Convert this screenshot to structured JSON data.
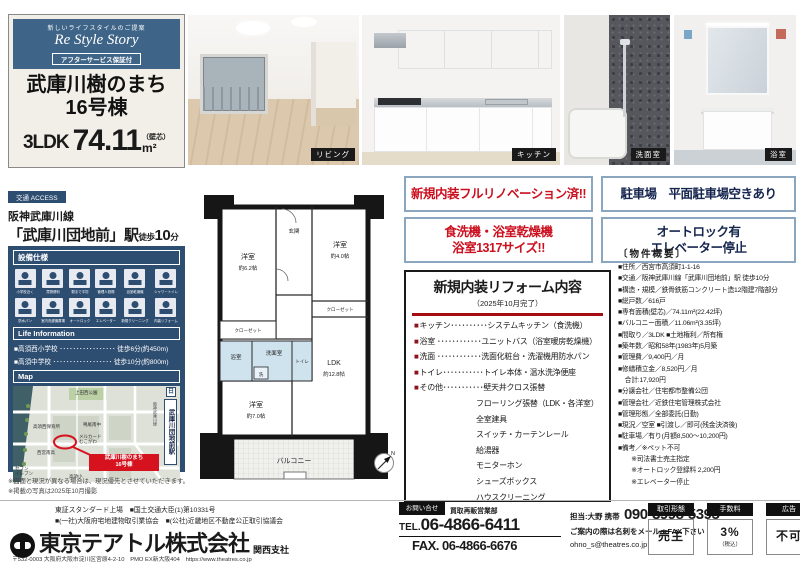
{
  "header": {
    "tagline": "新しいライフスタイルのご提案",
    "brand": "Re Style Story",
    "after_badge": "アフターサービス保証付",
    "name_line1": "武庫川樹のまち",
    "name_line2": "16号棟",
    "layout": "3LDK",
    "area": "74.11",
    "area_unit": "m²",
    "area_note": "（壁芯）"
  },
  "access": {
    "tag": "交通 ACCESS",
    "line": "阪神武庫川線",
    "station": "「武庫川団地前」駅",
    "walk_prefix": "徒歩",
    "walk_num": "10",
    "walk_suffix": "分"
  },
  "equipment": {
    "title": "設備仕様",
    "items": [
      {
        "icon": "school-icon",
        "label": "小学校近く"
      },
      {
        "icon": "shopping-icon",
        "label": "買物便利"
      },
      {
        "icon": "walk-icon",
        "label": "駅まで平坦"
      },
      {
        "icon": "manager-icon",
        "label": "管理人勤務"
      },
      {
        "icon": "shower-icon",
        "label": "浴室乾燥機"
      },
      {
        "icon": "toilet-icon",
        "label": "シャワートイレ"
      },
      {
        "icon": "laundry-pan-icon",
        "label": "防水パン"
      },
      {
        "icon": "washer-icon",
        "label": "室内洗濯機置場"
      },
      {
        "icon": "autolock-icon",
        "label": "オートロック"
      },
      {
        "icon": "elevator-icon",
        "label": "エレベーター"
      },
      {
        "icon": "cleaning-icon",
        "label": "新規クリーニング"
      },
      {
        "icon": "renovation-icon",
        "label": "内装リフォーム"
      }
    ]
  },
  "life": {
    "title": "Life Information",
    "items": [
      "■高須西小学校 ･････････････････ 徒歩6分(約450m)",
      "■高須中学校 ･･････････････････ 徒歩10分(約800m)"
    ]
  },
  "map": {
    "title": "Map",
    "labels": {
      "park": "上田西公園",
      "school_mid": "鳴尾南中",
      "nursery": "高須西保育所",
      "mall": "メルカード\nむこがわ",
      "high": "西宮南高",
      "conv": "セブン\nイレブン",
      "elem": "高須小"
    },
    "station": "武庫川団地前駅",
    "line": "阪神武庫川線",
    "logo": "日",
    "callout": "武庫川樹のまち\n16号棟"
  },
  "notes": [
    "※図面と現況が異なる場合は、現況優先とさせていただきます。",
    "※掲載の写真は2025年10月撮影"
  ],
  "photos": [
    {
      "caption": "リビング"
    },
    {
      "caption": "キッチン"
    },
    {
      "caption": "洗面室"
    },
    {
      "caption": "浴室"
    }
  ],
  "floorplan": {
    "balcony": "バルコニー",
    "genkan": "玄関",
    "w62": [
      "洋室",
      "約6.2帖"
    ],
    "w40": [
      "洋室",
      "約4.0帖"
    ],
    "w70": [
      "洋室",
      "約7.0帖"
    ],
    "ldk": [
      "LDK",
      "約12.8帖"
    ],
    "closet_left": "クローゼット",
    "closet_right": "クローゼット",
    "bath": "浴室",
    "wash": "洗面室",
    "toilet": "トイレ",
    "laundry": "洗",
    "compass": "N"
  },
  "highlights": [
    {
      "text": "新規内装フルリノベーション済!!",
      "tone": "red"
    },
    {
      "text": "駐車場　平面駐車場空きあり",
      "tone": "navy"
    },
    {
      "text": "食洗機・浴室乾燥機\n浴室1317サイズ!!",
      "tone": "red"
    },
    {
      "text": "オートロック有\nエレベーター停止",
      "tone": "navy"
    }
  ],
  "reform": {
    "title": "新規内装リフォーム内容",
    "subtitle": "（2025年10月完了）",
    "bullet": "■",
    "items": [
      "キッチン･･････････システムキッチン（食洗機）",
      "浴室 ････････････ユニットバス（浴室暖房乾燥機）",
      "洗面 ････････････洗面化粧台・洗濯機用防水パン",
      "トイレ･･･････････トイレ本体・温水洗浄便座",
      "その他･･･････････壁天井クロス張替"
    ],
    "extras": [
      "フローリング張替（LDK・各洋室）",
      "全室建具",
      "スイッチ・カーテンレール",
      "給湯器",
      "モニターホン",
      "シューズボックス",
      "ハウスクリーニング"
    ]
  },
  "outline": {
    "title": "〔物件概要〕",
    "items": [
      "■住所／西宮市高須町1-1-16",
      "■交通／阪神武庫川線「武庫川団地前」駅 徒歩10分",
      "■構造・規模／鉄骨鉄筋コンクリート造12階建7階部分",
      "■総戸数／616戸",
      "■専有面積(壁芯)／74.11m²(22.42坪)",
      "■バルコニー面積／11.06m²(3.35坪)",
      "■間取り／3LDK ■土地権利／所有権",
      "■築年数／昭和58年(1983年)5月築",
      "■管理費／9,400円／月",
      "■修繕積立金／8,520円／月",
      "　合計:17,920円",
      "■分譲会社／住宅都市整備公団",
      "■管理会社／近鉄住宅管理株式会社",
      "■管理形態／全部委託(日勤)",
      "■現況／空室 ■引渡し／即可(残金決済後)",
      "■駐車場／有り(月額8,500～10,200円)",
      "■備考／※ペット不可",
      "　　※司法書士売主指定",
      "　　※オートロック登録料 2,200円",
      "　　※エレベーター停止"
    ]
  },
  "footer": {
    "certs": [
      "東証スタンダード上場　■国土交通大臣(1)第10331号",
      "■(一社)大阪府宅地建物取引業協会　■(公社)近畿地区不動産公正取引協議会"
    ],
    "company": "東京テアトル株式会社",
    "branch": "関西支社",
    "address": "〒532-0003 大阪府大阪市淀川区宮原4-2-10　PMO EX新大阪404　https://www.theatres.co.jp",
    "inquiry_tab": "お問い合せ",
    "department": "買取再販営業部",
    "tel_label": "TEL.",
    "tel": "06-4866-6411",
    "fax": "FAX. 06-4866-6676",
    "person": "担当:大野 携帯",
    "mobile": "090-3998-5395",
    "note": "ご案内の際は名刺をメールorFAX下さい",
    "email": "ohno_s@theatres.co.jp",
    "badges": [
      {
        "label": "取引形態",
        "value": "売主",
        "note": ""
      },
      {
        "label": "手数料",
        "value": "3%",
        "note": "（税込）"
      },
      {
        "label": "広告",
        "value": "不可",
        "note": ""
      }
    ]
  }
}
